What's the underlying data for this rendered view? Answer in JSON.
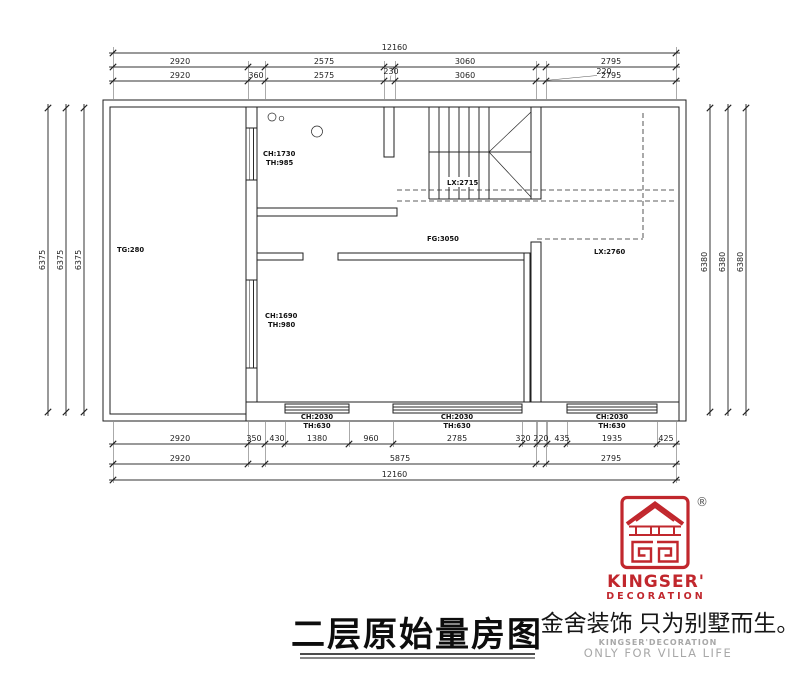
{
  "drawing": {
    "title": "二层原始量房图",
    "room_labels": {
      "tg": "TG:280",
      "fg": "FG:3050",
      "lx_stair": "LX:2715",
      "lx_right": "LX:2760",
      "window_top": {
        "l1": "CH:1730",
        "l2": "TH:985"
      },
      "window_mid": {
        "l1": "CH:1690",
        "l2": "TH:980"
      },
      "window_b1": {
        "l1": "CH:2030",
        "l2": "TH:630"
      },
      "window_b2": {
        "l1": "CH:2030",
        "l2": "TH:630"
      },
      "window_b3": {
        "l1": "CH:2030",
        "l2": "TH:630"
      }
    },
    "dims": {
      "total": "12160",
      "top2": [
        "2920",
        "2575",
        "3060",
        "2795"
      ],
      "top3": [
        "2920",
        "360",
        "2575",
        "3060",
        "2795"
      ],
      "top_small": [
        "230",
        "220"
      ],
      "bottom1": [
        "2920",
        "350",
        "430",
        "1380",
        "960",
        "2785",
        "320",
        "220",
        "435",
        "1935",
        "425"
      ],
      "bottom2": [
        "2920",
        "5875",
        "2795"
      ],
      "left": [
        "6375",
        "6375",
        "6375"
      ],
      "right": [
        "6380",
        "6380",
        "6380"
      ]
    }
  },
  "branding": {
    "slogan": "金舍装饰 只为别墅而生。",
    "brand_line": "KINGSER'DECORATION",
    "tagline": "ONLY FOR VILLA LIFE",
    "logo_text": "KINGSER'",
    "logo_subtext": "DECORATION",
    "registered": "®",
    "colors": {
      "red": "#c1272d",
      "gray": "#a8a8a8"
    }
  }
}
